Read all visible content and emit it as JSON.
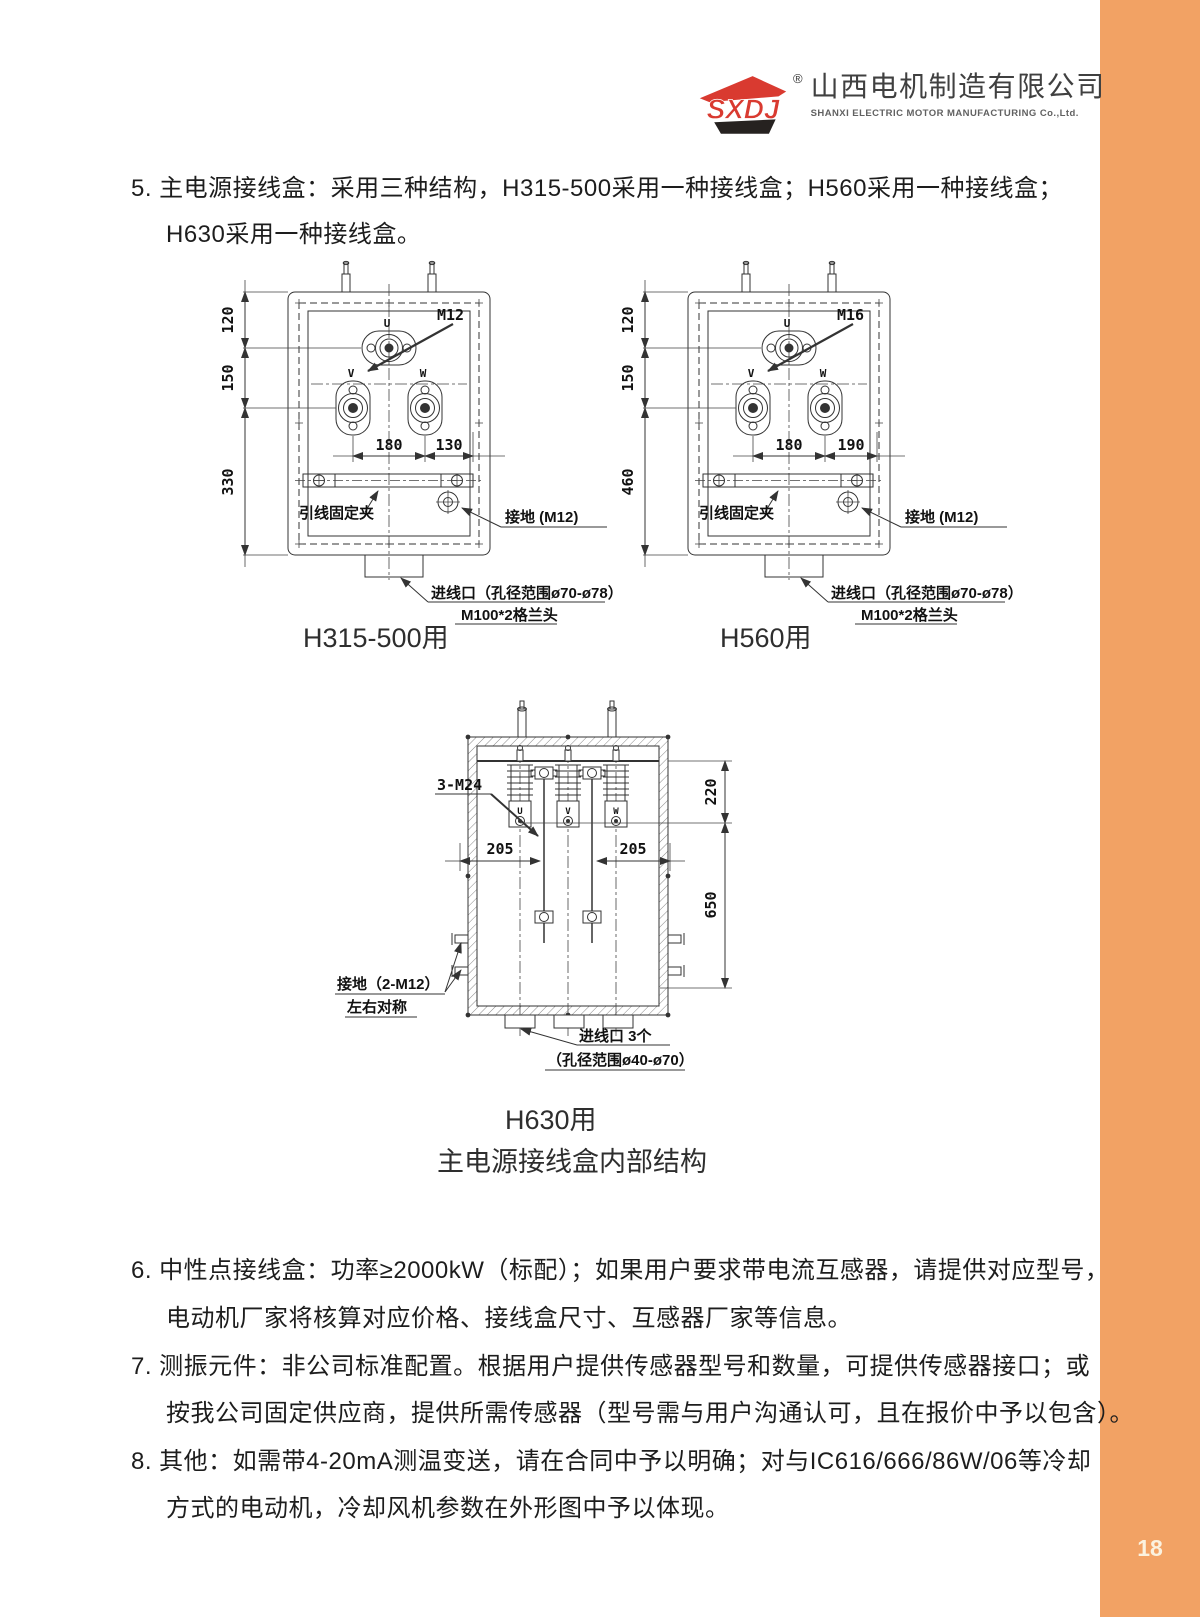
{
  "page": {
    "number": "18",
    "accent_color": "#F2A264"
  },
  "logo": {
    "abbr": "SXDJ",
    "reg": "®",
    "company_cn": "山西电机制造有限公司",
    "company_en": "SHANXI ELECTRIC MOTOR MANUFACTURING Co.,Ltd.",
    "red": "#D93A30",
    "dark": "#262220"
  },
  "section5": {
    "line1": "5. 主电源接线盒：采用三种结构，H315-500采用一种接线盒；H560采用一种接线盒；",
    "line2": "H630采用一种接线盒。"
  },
  "drawing_a": {
    "caption": "H315-500用",
    "stud_label": "M12",
    "terminal_u": "U",
    "terminal_v": "V",
    "terminal_w": "W",
    "dim_top": "120",
    "dim_mid": "150",
    "dim_bottom": "330",
    "dim_vw": "180",
    "dim_wr": "130",
    "clamp_label": "引线固定夹",
    "ground_label": "接地 (M12)",
    "inlet_line1": "进线口（孔径范围ø70-ø78）",
    "inlet_line2": "M100*2格兰头"
  },
  "drawing_b": {
    "caption": "H560用",
    "stud_label": "M16",
    "terminal_u": "U",
    "terminal_v": "V",
    "terminal_w": "W",
    "dim_top": "120",
    "dim_mid": "150",
    "dim_bottom": "460",
    "dim_vw": "180",
    "dim_wr": "190",
    "clamp_label": "引线固定夹",
    "ground_label": "接地 (M12)",
    "inlet_line1": "进线口（孔径范围ø70-ø78）",
    "inlet_line2": "M100*2格兰头"
  },
  "drawing_c": {
    "caption": "H630用",
    "stud_label": "3-M24",
    "terminal_u": "U",
    "terminal_v": "V",
    "terminal_w": "W",
    "dim_left205": "205",
    "dim_right205": "205",
    "dim_220": "220",
    "dim_650": "650",
    "ground_line1": "接地（2-M12）",
    "ground_line2": "左右对称",
    "inlet_line1": "进线口 3个",
    "inlet_line2": "（孔径范围ø40-ø70）"
  },
  "figure_title": "主电源接线盒内部结构",
  "notes": [
    {
      "line1": "6. 中性点接线盒：功率≥2000kW（标配）；如果用户要求带电流互感器，请提供对应型号，",
      "line2": "电动机厂家将核算对应价格、接线盒尺寸、互感器厂家等信息。"
    },
    {
      "line1": "7. 测振元件：非公司标准配置。根据用户提供传感器型号和数量，可提供传感器接口；或",
      "line2": "按我公司固定供应商，提供所需传感器（型号需与用户沟通认可，且在报价中予以包含）。"
    },
    {
      "line1": "8. 其他：如需带4-20mA测温变送，请在合同中予以明确；对与IC616/666/86W/06等冷却",
      "line2": "方式的电动机，冷却风机参数在外形图中予以体现。"
    }
  ]
}
